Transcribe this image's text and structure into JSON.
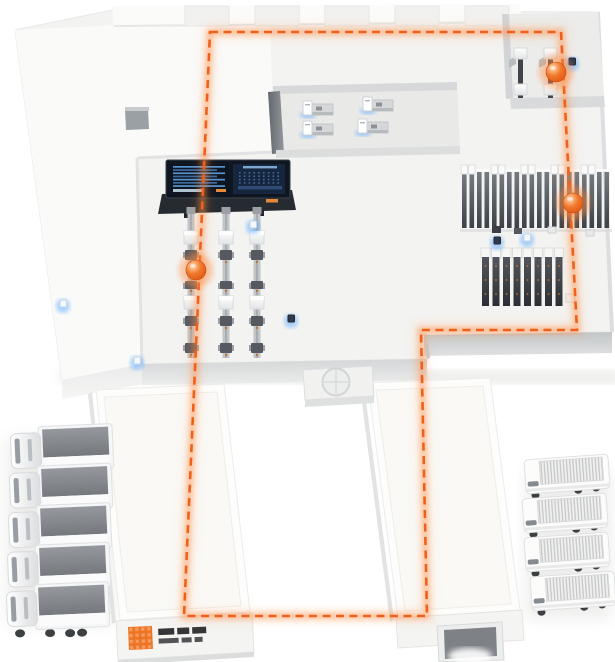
{
  "title": "smart-factory-logistics-isometric-map",
  "colors": {
    "accent": "#f1601a",
    "accent_glow": "#ff8b3f",
    "sensor_blue": "#58a8ff",
    "platform": "#f6f6f4",
    "floor": "#efefed",
    "room_floor": "#e9e9e8",
    "wall_dark": "#6f7478",
    "fascia": "#c9cccd",
    "screen_bg": "#10161f",
    "screen_line": "#5c9bd8",
    "truck_top_gray": "#84888d"
  },
  "route": {
    "color": "#f1601a",
    "dash": [
      8,
      5.5
    ],
    "closed": true,
    "points": [
      [
        210,
        32
      ],
      [
        561,
        32
      ],
      [
        577,
        330
      ],
      [
        421,
        330
      ],
      [
        427,
        616
      ],
      [
        184,
        616
      ]
    ]
  },
  "agv_markers": [
    {
      "x": 556,
      "y": 72
    },
    {
      "x": 573,
      "y": 203
    },
    {
      "x": 196,
      "y": 270
    }
  ],
  "sensors": [
    {
      "x": 63,
      "y": 303,
      "v": "w"
    },
    {
      "x": 137,
      "y": 360,
      "v": "w"
    },
    {
      "x": 253,
      "y": 224,
      "v": "w"
    },
    {
      "x": 291,
      "y": 318,
      "v": "d"
    },
    {
      "x": 497,
      "y": 240,
      "v": "d"
    },
    {
      "x": 527,
      "y": 237,
      "v": "w"
    },
    {
      "x": 572,
      "y": 61,
      "v": "d"
    }
  ],
  "workstations": [
    {
      "x": 303,
      "y": 101
    },
    {
      "x": 363,
      "y": 97
    },
    {
      "x": 303,
      "y": 121
    },
    {
      "x": 358,
      "y": 119
    }
  ],
  "conveyors": {
    "xs": [
      191,
      226,
      257
    ],
    "top": 213,
    "bottom": 358,
    "white_stations": [
      231,
      296
    ],
    "machines": [
      250,
      281,
      316,
      343
    ]
  },
  "rack_row": {
    "x0": 462,
    "step": 7.5,
    "count": 20,
    "y": 172,
    "h": 56
  },
  "cabinets": {
    "x0": 482,
    "step": 10.5,
    "count": 8,
    "y": 248,
    "h": 58
  },
  "top_right_machines": {
    "xs": [
      518,
      548
    ],
    "y": 50
  },
  "roof_beams": {
    "xs": [
      185,
      255,
      325,
      395,
      465
    ],
    "y": 6,
    "w": 44,
    "h": 20
  },
  "left_trucks": {
    "count": 5,
    "x": 8,
    "y0": 428,
    "dy": 39.5
  },
  "right_trucks": {
    "positions": [
      [
        524,
        460
      ],
      [
        522,
        499
      ],
      [
        524,
        538
      ],
      [
        530,
        577
      ]
    ]
  },
  "logo": {
    "mark": "orange-pixel-grid-logo",
    "mark_color": "#ee7422",
    "text_line1_segments": [
      16,
      12,
      14
    ],
    "text_line2_segments": [
      20,
      10,
      8
    ]
  }
}
